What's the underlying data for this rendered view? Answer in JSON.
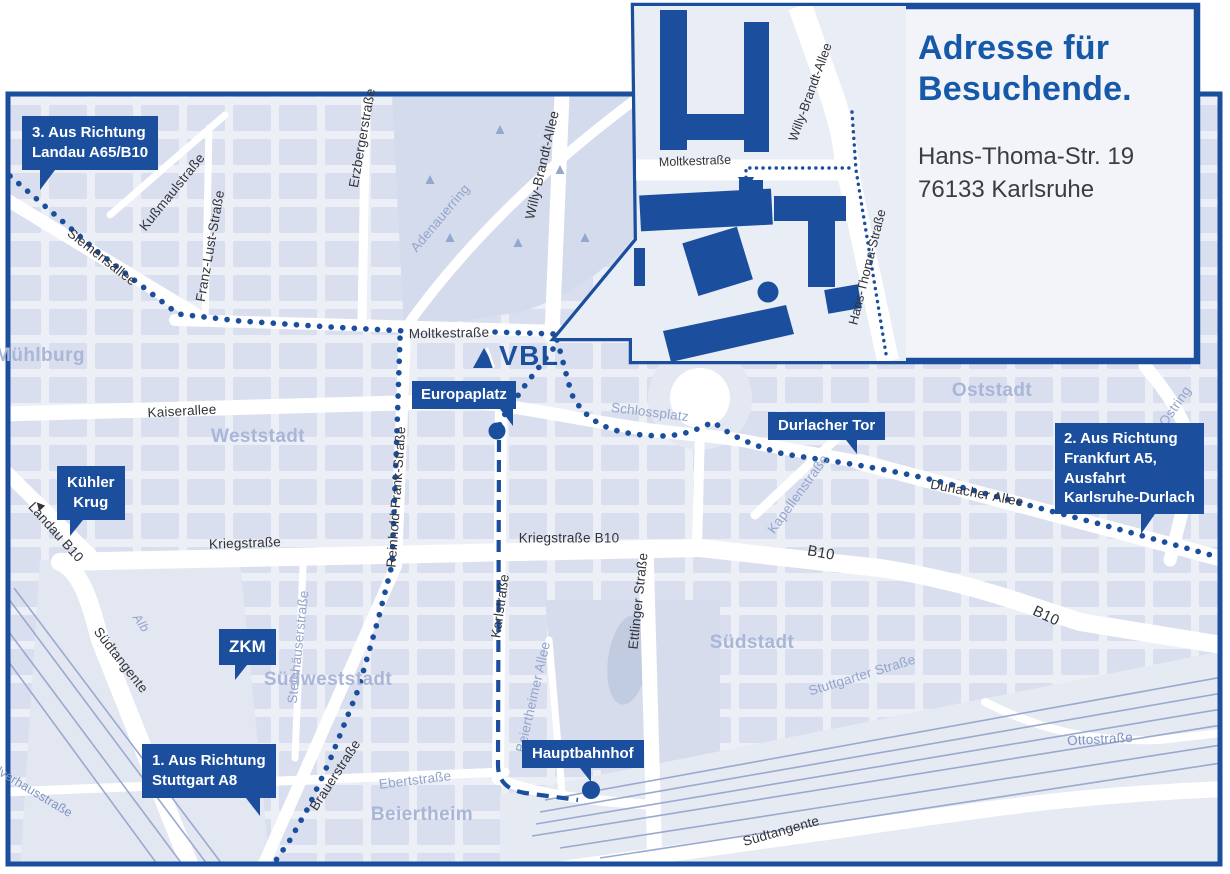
{
  "colors": {
    "brand_blue": "#1b4f9e",
    "heading_blue": "#1559a8",
    "map_background": "#edeff6",
    "block_fill": "#d9dfee",
    "district_label": "#a9b6d8",
    "light_street_label": "#93a5cb",
    "dark_street_label": "#33343a",
    "railway_line": "#9aa9ce"
  },
  "logo": {
    "text": "VBL"
  },
  "inset": {
    "heading": [
      "Adresse für",
      "Besuchende."
    ],
    "address": [
      "Hans-Thoma-Str. 19",
      "76133 Karlsruhe"
    ]
  },
  "badges": {
    "landau": {
      "line1": "3. Aus Richtung",
      "line2": "Landau A65/B10"
    },
    "kuehler_krug": {
      "line1": "Kühler",
      "line2": "Krug"
    },
    "zkm": {
      "line1": "ZKM"
    },
    "stuttgart": {
      "line1": "1. Aus Richtung",
      "line2": "Stuttgart A8"
    },
    "europaplatz": {
      "line1": "Europaplatz"
    },
    "durlacher_tor": {
      "line1": "Durlacher Tor"
    },
    "frankfurt": {
      "line1": "2. Aus Richtung",
      "line2": "Frankfurt A5,",
      "line3": "Ausfahrt",
      "line4": "Karlsruhe-Durlach"
    },
    "hauptbahnhof": {
      "line1": "Hauptbahnhof"
    }
  },
  "districts": {
    "muehlburg": "Mühlburg",
    "weststadt": "Weststadt",
    "oststadt": "Oststadt",
    "suedweststadt": "Südweststadt",
    "suedstadt": "Südstadt",
    "beiertheim": "Beiertheim"
  },
  "streets": {
    "siemensallee": "Siemensallee",
    "kussmaulstrasse": "Kußmaulstraße",
    "franz_lust_strasse": "Franz-Lust-Straße",
    "erzbergerstrasse": "Erzbergerstraße",
    "adenauerring": "Adenauerring",
    "willy_brandt_allee": "Willy-Brandt-Allee",
    "moltkestrasse": "Moltkestraße",
    "kaiserallee": "Kaiserallee",
    "kriegstrasse": "Kriegstraße",
    "kriegstrasse_b10": "Kriegstraße B10",
    "reinhold_frank_strasse": "Reinhold-Frank-Straße",
    "karlstrasse": "Karlstraße",
    "ettlinger_strasse": "Ettlinger Straße",
    "beiertheimer_allee": "Beiertheimer Allee",
    "steinhaeuserstrasse": "Steinhäuserstraße",
    "brauerstrasse": "Brauerstraße",
    "ebertstrasse": "Ebertstraße",
    "stuttgarter_strasse": "Stuttgarter Straße",
    "ottostrasse": "Ottostraße",
    "suedtangente": "Südtangente",
    "durlacher_allee": "Durlacher Allee",
    "kapellenstrasse": "Kapellenstraße",
    "schlossplatz": "Schlossplatz",
    "ostring": "Ostring",
    "b10": "B10",
    "landau_b10": "Landau B10",
    "landau_arrow": "◄",
    "alb": "Alb",
    "pulverhausstrasse": "Pulverhausstraße",
    "hans_thoma_strasse": "Hans-Thoma-Straße"
  }
}
